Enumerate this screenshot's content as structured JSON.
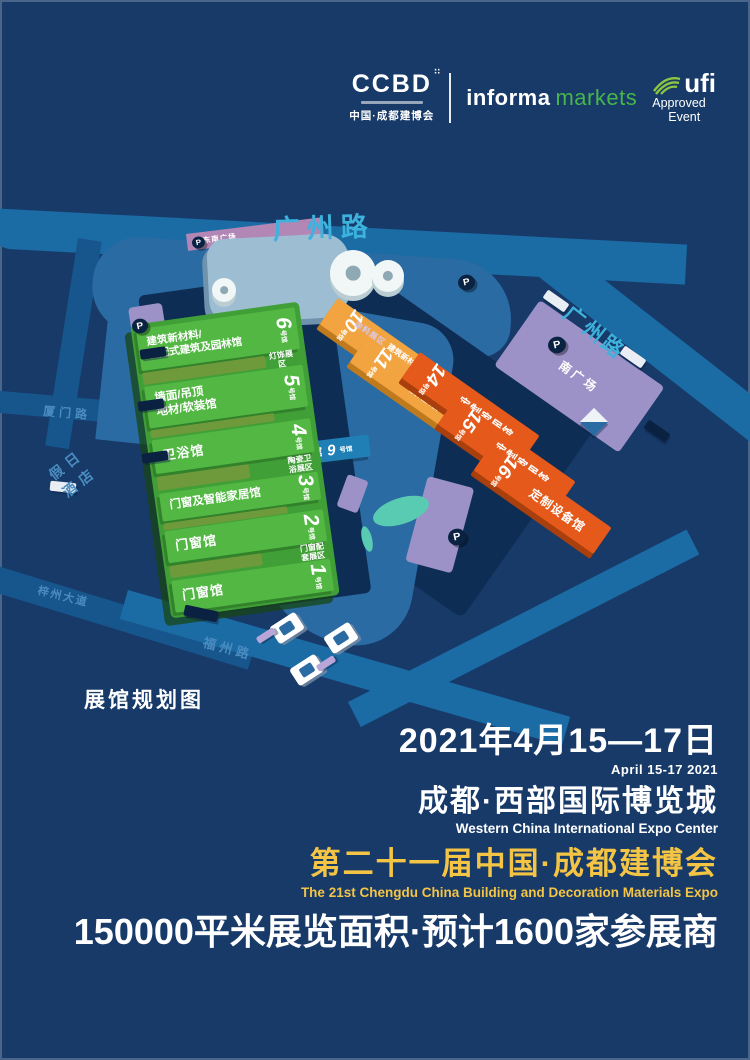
{
  "header": {
    "ccbd": {
      "name": "CCBD",
      "subtitle": "中国·成都建博会"
    },
    "informa": {
      "part1": "informa",
      "part2": "markets",
      "green": "#46b649"
    },
    "ufi": {
      "name": "ufi",
      "approved": "Approved",
      "event": "Event",
      "green": "#8dc63f"
    }
  },
  "map": {
    "title": "展馆规划图",
    "parking": "P",
    "hall_suffix": "号馆",
    "roads": {
      "top": "广州路",
      "right": "广州路",
      "left": "厦门路",
      "avenue": "梓州大道",
      "bottom": "福州路"
    },
    "hotel": "假日\n酒店",
    "plazas": {
      "southeast": "东南广场",
      "south": "南广场"
    },
    "forum": {
      "label": "活动论坛馆",
      "num": "9"
    },
    "green_halls": [
      {
        "num": "6",
        "label": "建筑新材料/\n装配式建筑及园林馆"
      },
      {
        "num": "5",
        "label": "墙面/吊顶\n地材/软装馆"
      },
      {
        "num": "4",
        "label": "卫浴馆"
      },
      {
        "num": "3",
        "label": "门窗及智能家居馆"
      },
      {
        "num": "2",
        "label": "门窗馆"
      },
      {
        "num": "1",
        "label": "门窗馆"
      }
    ],
    "green_zones": [
      {
        "label": "灯饰展区"
      },
      {
        "label": "陶瓷卫\n浴展区"
      },
      {
        "label": "门窗配\n套展区"
      }
    ],
    "orange_halls": [
      {
        "num": "10",
        "label": "建筑新材料/\n装配式建筑及园林馆"
      },
      {
        "num": "11",
        "label": "暖通馆"
      },
      {
        "num": "14",
        "label": "定制家居馆"
      },
      {
        "num": "15",
        "label": "定制家居馆"
      },
      {
        "num": "16",
        "label": "定制设备馆"
      }
    ],
    "orange_zone": "涂料展区",
    "colors": {
      "background": "#173a69",
      "road": "#1b6ba4",
      "green_hall": "#52b843",
      "amber_hall": "#f2a440",
      "orange_hall": "#e55a1b",
      "purple": "#9c92c8",
      "road_text": "#3db2dc"
    }
  },
  "footer": {
    "date_cn": "2021年4月15—17日",
    "date_en": "April 15-17 2021",
    "venue_cn": "成都·西部国际博览城",
    "venue_en": "Western China International Expo Center",
    "expo_cn": "第二十一届中国·成都建博会",
    "expo_en": "The 21st Chengdu China Building and Decoration Materials Expo",
    "stats": "150000平米展览面积·预计1600家参展商",
    "gold": "#f4c444"
  }
}
